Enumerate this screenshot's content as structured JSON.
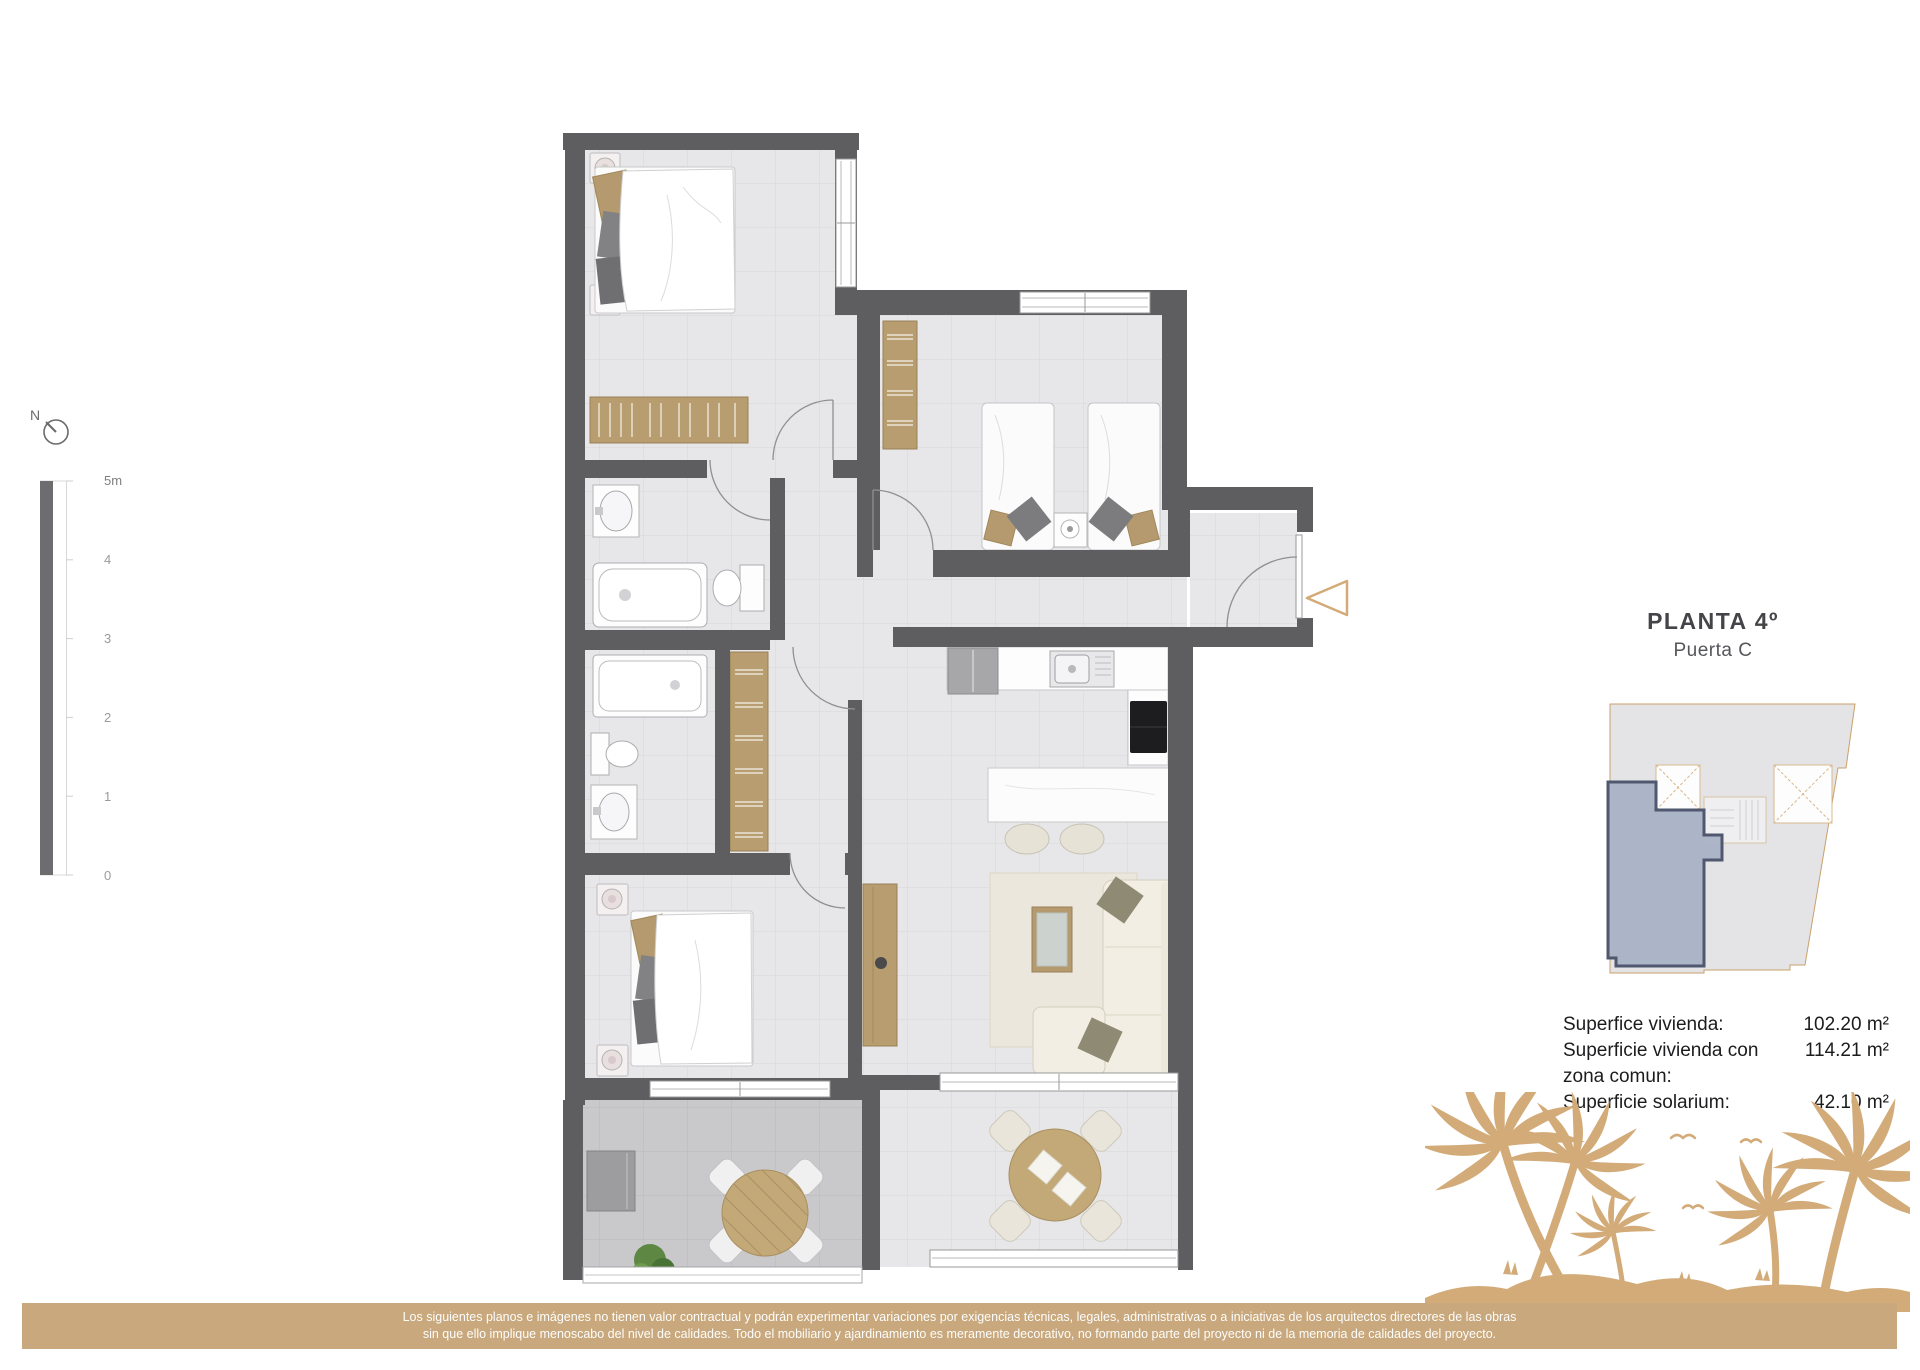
{
  "title_block": {
    "title": "PLANTA 4º",
    "subtitle": "Puerta C"
  },
  "compass": {
    "label": "N"
  },
  "scale_bar": {
    "labels": [
      "5m",
      "4",
      "3",
      "2",
      "1",
      "0"
    ]
  },
  "area_table": {
    "rows": [
      {
        "label": "Superfice vivienda:",
        "value": "102.20 m²"
      },
      {
        "label": "Superficie vivienda con zona comun:",
        "value": "114.21 m²"
      },
      {
        "label": "Superficie solarium:",
        "value": "42.10 m²"
      }
    ]
  },
  "disclaimer": {
    "line1": "Los siguientes planos e imágenes no tienen valor contractual y podrán experimentar variaciones por exigencias técnicas, legales, administrativas o a iniciativas de los arquitectos directores de las obras",
    "line2": "sin que ello implique menoscabo del nivel de calidades. Todo el mobiliario y ajardinamiento es meramente decorativo, no formando parte del proyecto ni de la memoria de calidades del proyecto."
  },
  "floor_plan": {
    "rooms": [
      "bedroom-1",
      "bedroom-2",
      "bedroom-3",
      "bathroom-1",
      "bathroom-2",
      "hall",
      "kitchen",
      "living-dining",
      "entrance",
      "terrace-left",
      "terrace-right"
    ]
  },
  "colors": {
    "wall": "#5e5e60",
    "accent_tan": "#d2ab79",
    "disclaimer_bar": "#c8a87c",
    "wood": "#b79d70",
    "unit_highlight": "#a9b2c6",
    "unit_border": "#4f586f"
  }
}
